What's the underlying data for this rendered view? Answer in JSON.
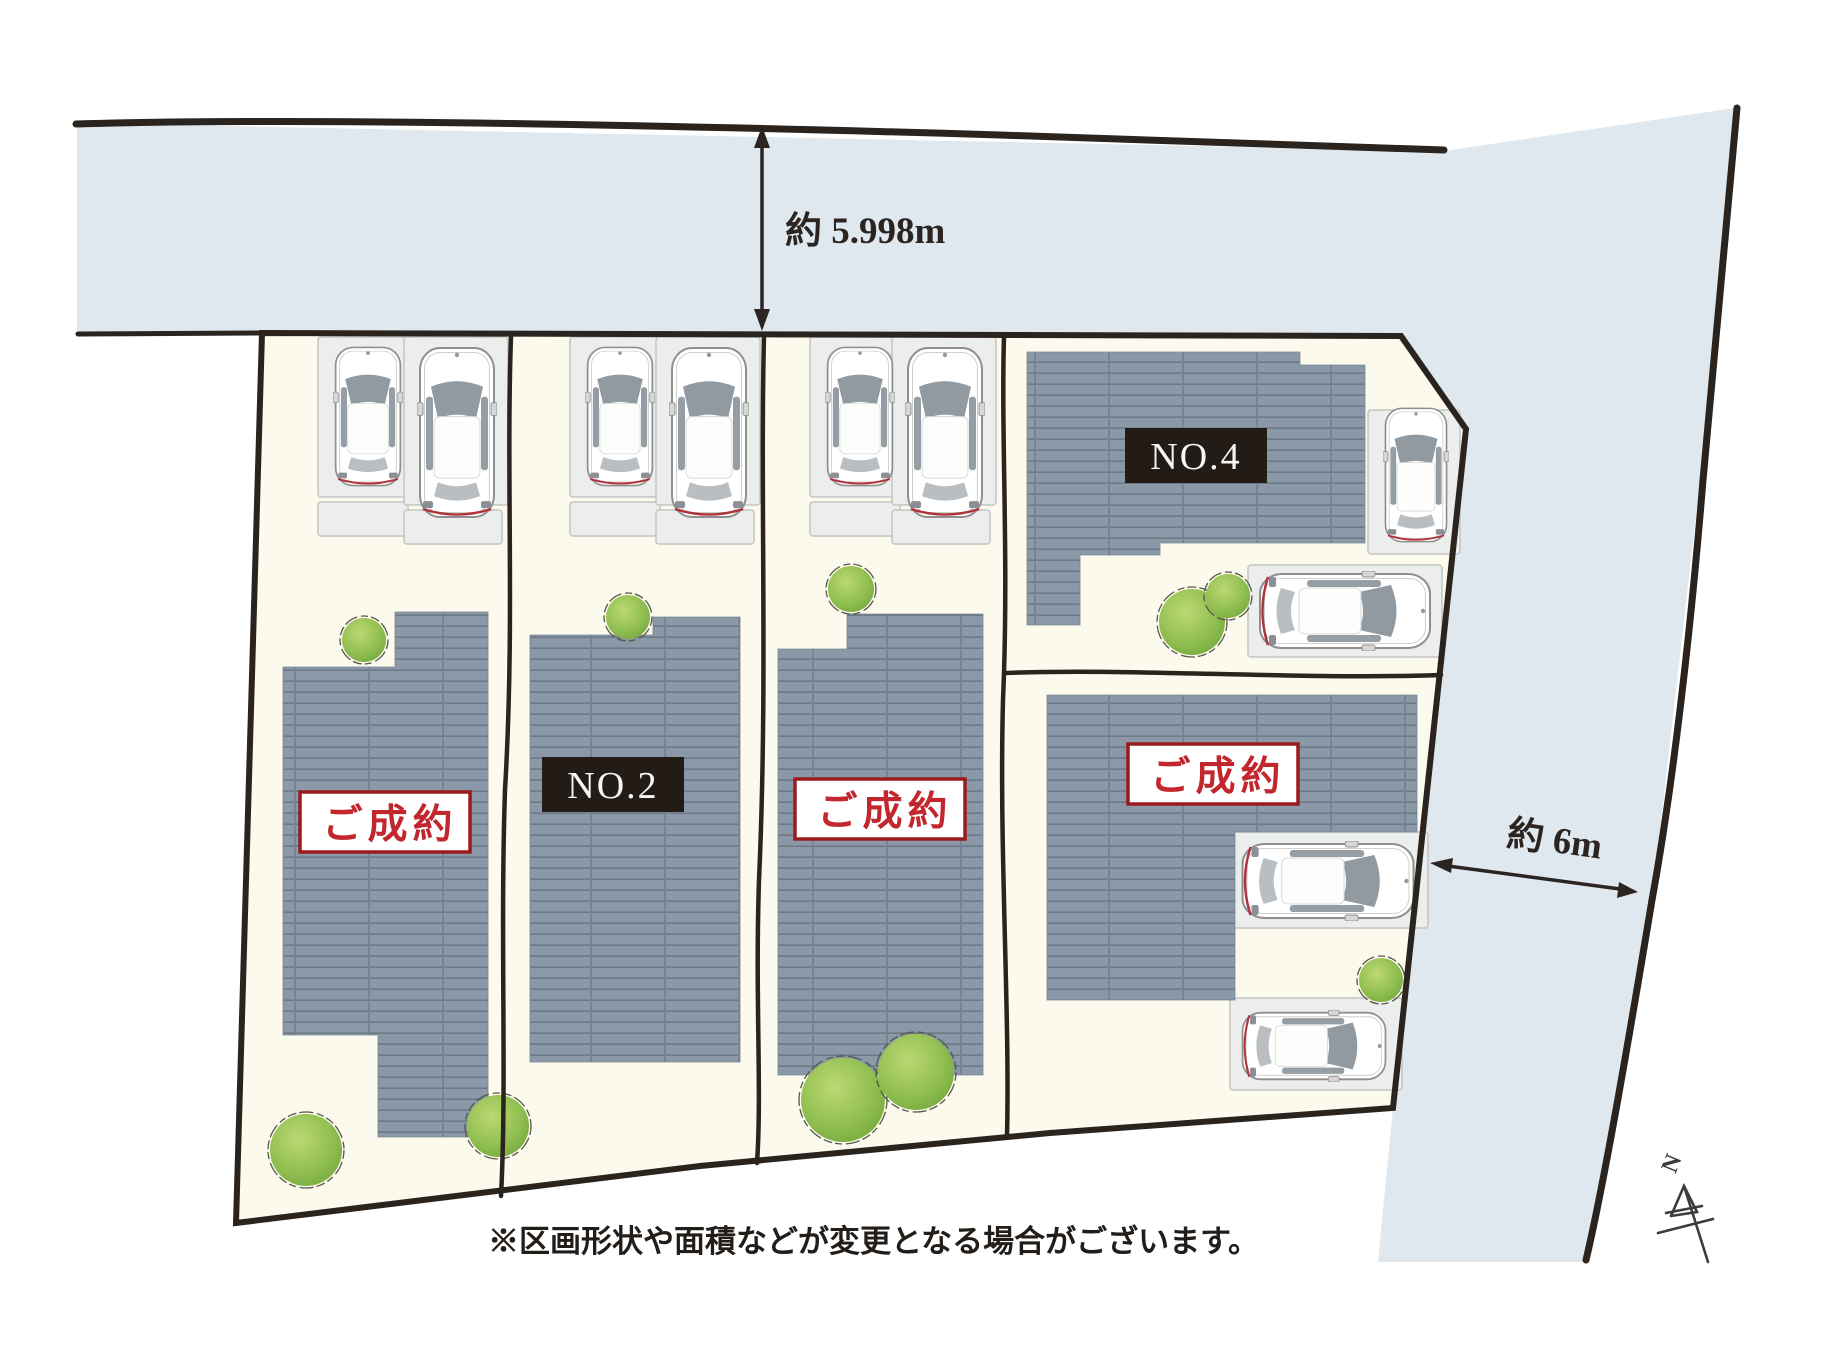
{
  "plan": {
    "disclaimer": "※区画形状や面積などが変更となる場合がございます。",
    "dimensions": {
      "north_road_width": "約 5.998m",
      "east_road_width": "約 6m"
    },
    "compass": {
      "north": "N"
    },
    "lots": [
      {
        "id": "1",
        "label": "ご成約",
        "status": "sold"
      },
      {
        "id": "2",
        "label": "NO.2",
        "status": "for-sale"
      },
      {
        "id": "3",
        "label": "ご成約",
        "status": "sold"
      },
      {
        "id": "4",
        "label": "NO.4",
        "status": "for-sale"
      },
      {
        "id": "5",
        "label": "ご成約",
        "status": "sold"
      }
    ],
    "colors": {
      "road": "#dfe8ee",
      "land": "#fbfaec",
      "roof": "#8a98a7",
      "sold_text": "#c1272d",
      "sold_border": "#9a1a1e",
      "number_box": "#221b16",
      "outline": "#2a231e",
      "tree": "#8cbb4e"
    }
  }
}
